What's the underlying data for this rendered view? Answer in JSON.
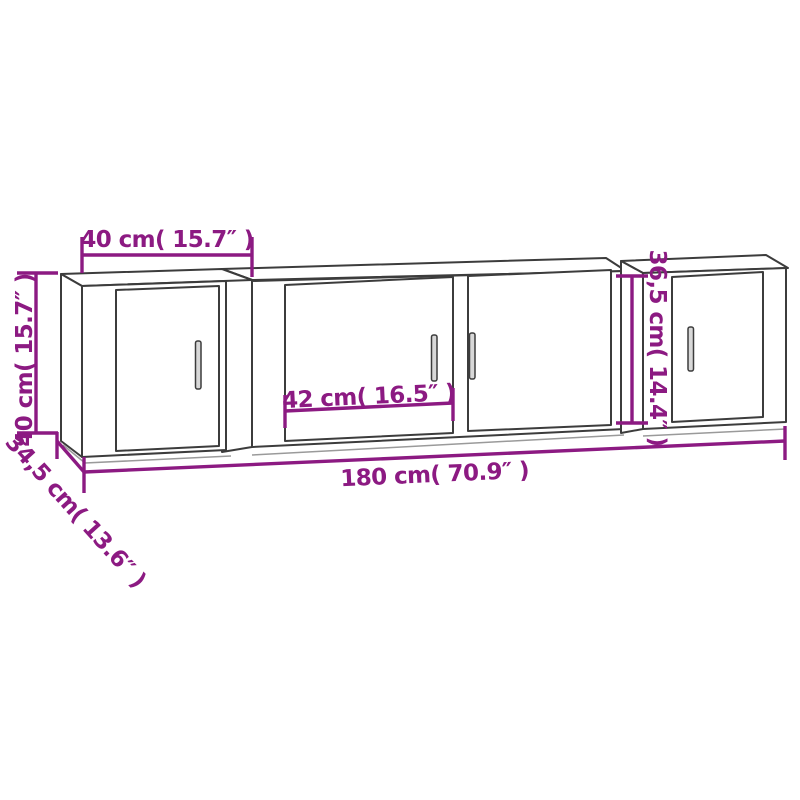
{
  "diagram": {
    "description": "Line drawing of a three-piece wall-mounted TV cabinet set with dimension annotations",
    "colors": {
      "dimension_accent": "#8C1A82",
      "outline": "#3C3C3C",
      "outline_light": "#9A9A9A",
      "background": "#FFFFFF"
    },
    "labels": {
      "top_width": "40 cm( 15.7″ )",
      "left_height": "40 cm( 15.7″ )",
      "door_width": "42 cm( 16.5″ )",
      "total_width": "180 cm( 70.9″ )",
      "depth": "34,5 cm( 13.6″ )",
      "middle_height": "36,5 cm( 14.4″ )"
    }
  }
}
